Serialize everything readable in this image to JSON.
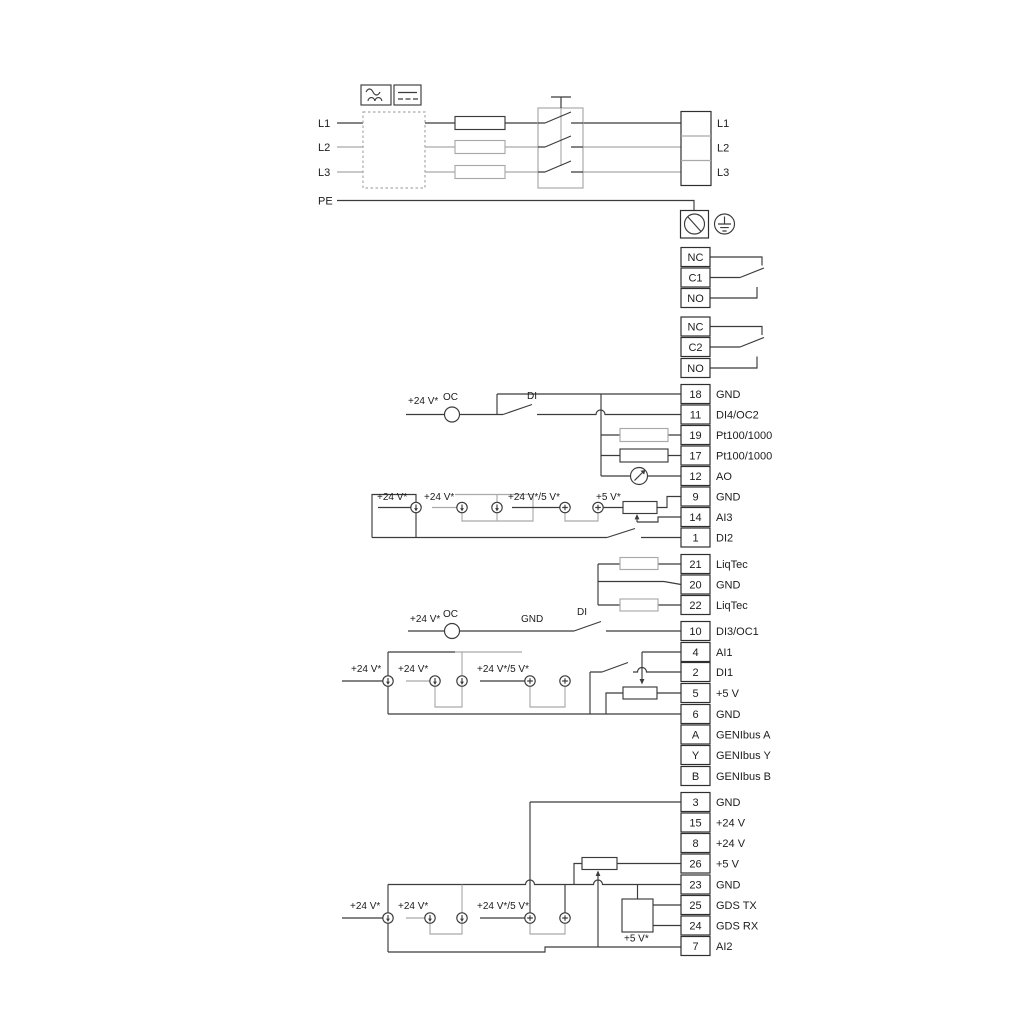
{
  "power": {
    "inputs": [
      "L1",
      "L2",
      "L3",
      "PE"
    ],
    "outputs": [
      "L1",
      "L2",
      "L3"
    ]
  },
  "relay1": {
    "terminals": [
      "NC",
      "C1",
      "NO"
    ]
  },
  "relay2": {
    "terminals": [
      "NC",
      "C2",
      "NO"
    ]
  },
  "io": {
    "g1": [
      {
        "num": "18",
        "label": "GND"
      },
      {
        "num": "11",
        "label": "DI4/OC2"
      },
      {
        "num": "19",
        "label": "Pt100/1000"
      },
      {
        "num": "17",
        "label": "Pt100/1000"
      },
      {
        "num": "12",
        "label": "AO"
      },
      {
        "num": "9",
        "label": "GND"
      },
      {
        "num": "14",
        "label": "AI3"
      },
      {
        "num": "1",
        "label": "DI2"
      }
    ],
    "g2": [
      {
        "num": "21",
        "label": "LiqTec"
      },
      {
        "num": "20",
        "label": "GND"
      },
      {
        "num": "22",
        "label": "LiqTec"
      }
    ],
    "g3": [
      {
        "num": "10",
        "label": "DI3/OC1"
      },
      {
        "num": "4",
        "label": "AI1"
      },
      {
        "num": "2",
        "label": "DI1"
      },
      {
        "num": "5",
        "label": "+5 V"
      },
      {
        "num": "6",
        "label": "GND"
      },
      {
        "num": "A",
        "label": "GENIbus A"
      },
      {
        "num": "Y",
        "label": "GENIbus Y"
      },
      {
        "num": "B",
        "label": "GENIbus B"
      }
    ],
    "g4": [
      {
        "num": "3",
        "label": "GND"
      },
      {
        "num": "15",
        "label": "+24 V"
      },
      {
        "num": "8",
        "label": "+24 V"
      },
      {
        "num": "26",
        "label": "+5 V"
      },
      {
        "num": "23",
        "label": "GND"
      },
      {
        "num": "25",
        "label": "GDS TX"
      },
      {
        "num": "24",
        "label": "GDS RX"
      },
      {
        "num": "7",
        "label": "AI2"
      }
    ]
  },
  "annotations": {
    "p24": "+24 V*",
    "p24_5": "+24 V*/5 V*",
    "p5s": "+5 V*",
    "oc": "OC",
    "di": "DI",
    "gnd": "GND"
  },
  "colors": {
    "line": "#3b3b3b",
    "gray": "#a9a9a9",
    "background": "#ffffff"
  }
}
